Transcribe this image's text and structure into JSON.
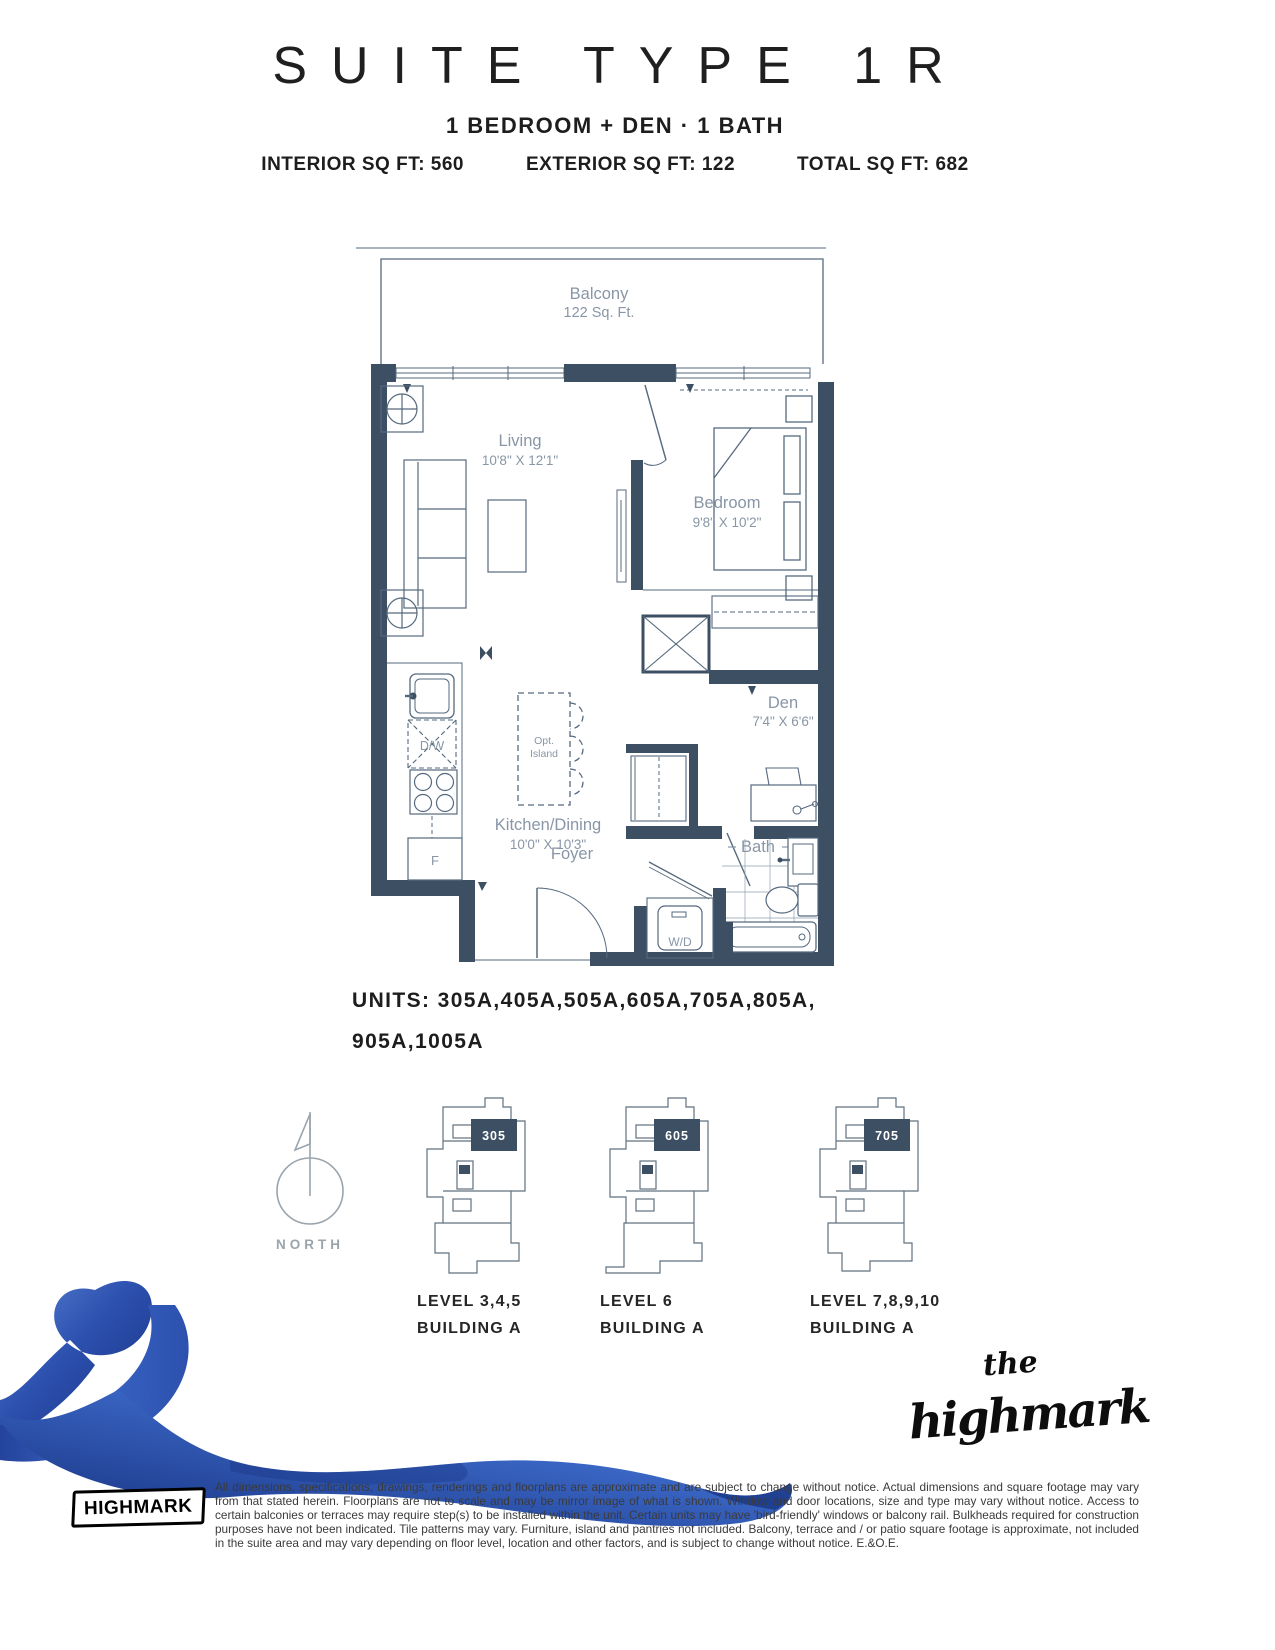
{
  "header": {
    "title": "SUITE TYPE 1R",
    "subtitle": "1 BEDROOM + DEN · 1 BATH",
    "stats": {
      "interior": "INTERIOR SQ FT: 560",
      "exterior": "EXTERIOR SQ FT: 122",
      "total": "TOTAL SQ FT: 682"
    }
  },
  "floorplan": {
    "rooms": {
      "balcony": {
        "name": "Balcony",
        "size": "122 Sq. Ft."
      },
      "living": {
        "name": "Living",
        "size": "10'8\" X 12'1\""
      },
      "bedroom": {
        "name": "Bedroom",
        "size": "9'8\" X 10'2\""
      },
      "den": {
        "name": "Den",
        "size": "7'4\" X 6'6\""
      },
      "kitchen": {
        "name": "Kitchen/Dining",
        "size": "10'0\" X 10'3\""
      },
      "bath": {
        "name": "Bath"
      },
      "foyer": {
        "name": "Foyer"
      }
    },
    "fixtures": {
      "dishwasher": "D/W",
      "fridge": "F",
      "washer_dryer": "W/D",
      "island_line1": "Opt.",
      "island_line2": "Island"
    }
  },
  "units": {
    "line1": "UNITS: 305A,405A,505A,605A,705A,805A,",
    "line2": "905A,1005A"
  },
  "north": {
    "label": "NORTH"
  },
  "keyplans": [
    {
      "badge": "305",
      "level": "LEVEL 3,4,5",
      "building": "BUILDING A"
    },
    {
      "badge": "605",
      "level": "LEVEL 6",
      "building": "BUILDING A"
    },
    {
      "badge": "705",
      "level": "LEVEL 7,8,9,10",
      "building": "BUILDING A"
    }
  ],
  "branding": {
    "script_small": "the",
    "script_main": "highmark",
    "stamp": "HIGHMARK"
  },
  "disclaimer": "All dimensions, specifications, drawings, renderings and floorplans are approximate and are subject to change without notice. Actual dimensions and square footage may vary from that stated herein. Floorplans are not to scale and may be mirror image of what is shown. Window and door locations, size and type may vary without notice. Access to certain balconies or terraces may require step(s) to be installed within the unit. Certain units may have 'bird-friendly' windows or balcony rail. Bulkheads required for construction purposes have not been indicated. Tile patterns may vary. Furniture, island and pantries not included. Balcony, terrace and / or patio square footage is approximate, not included in the suite area and may vary depending on floor level, location and other factors, and is subject to change without notice. E.&O.E.",
  "colors": {
    "wall": "#3d4f63",
    "thin_line": "#56697e",
    "plan_label": "#8896a6",
    "keyplan_line": "#60707f",
    "north_gray": "#9aa4ad",
    "ribbon_blue": "#2c50ae"
  }
}
